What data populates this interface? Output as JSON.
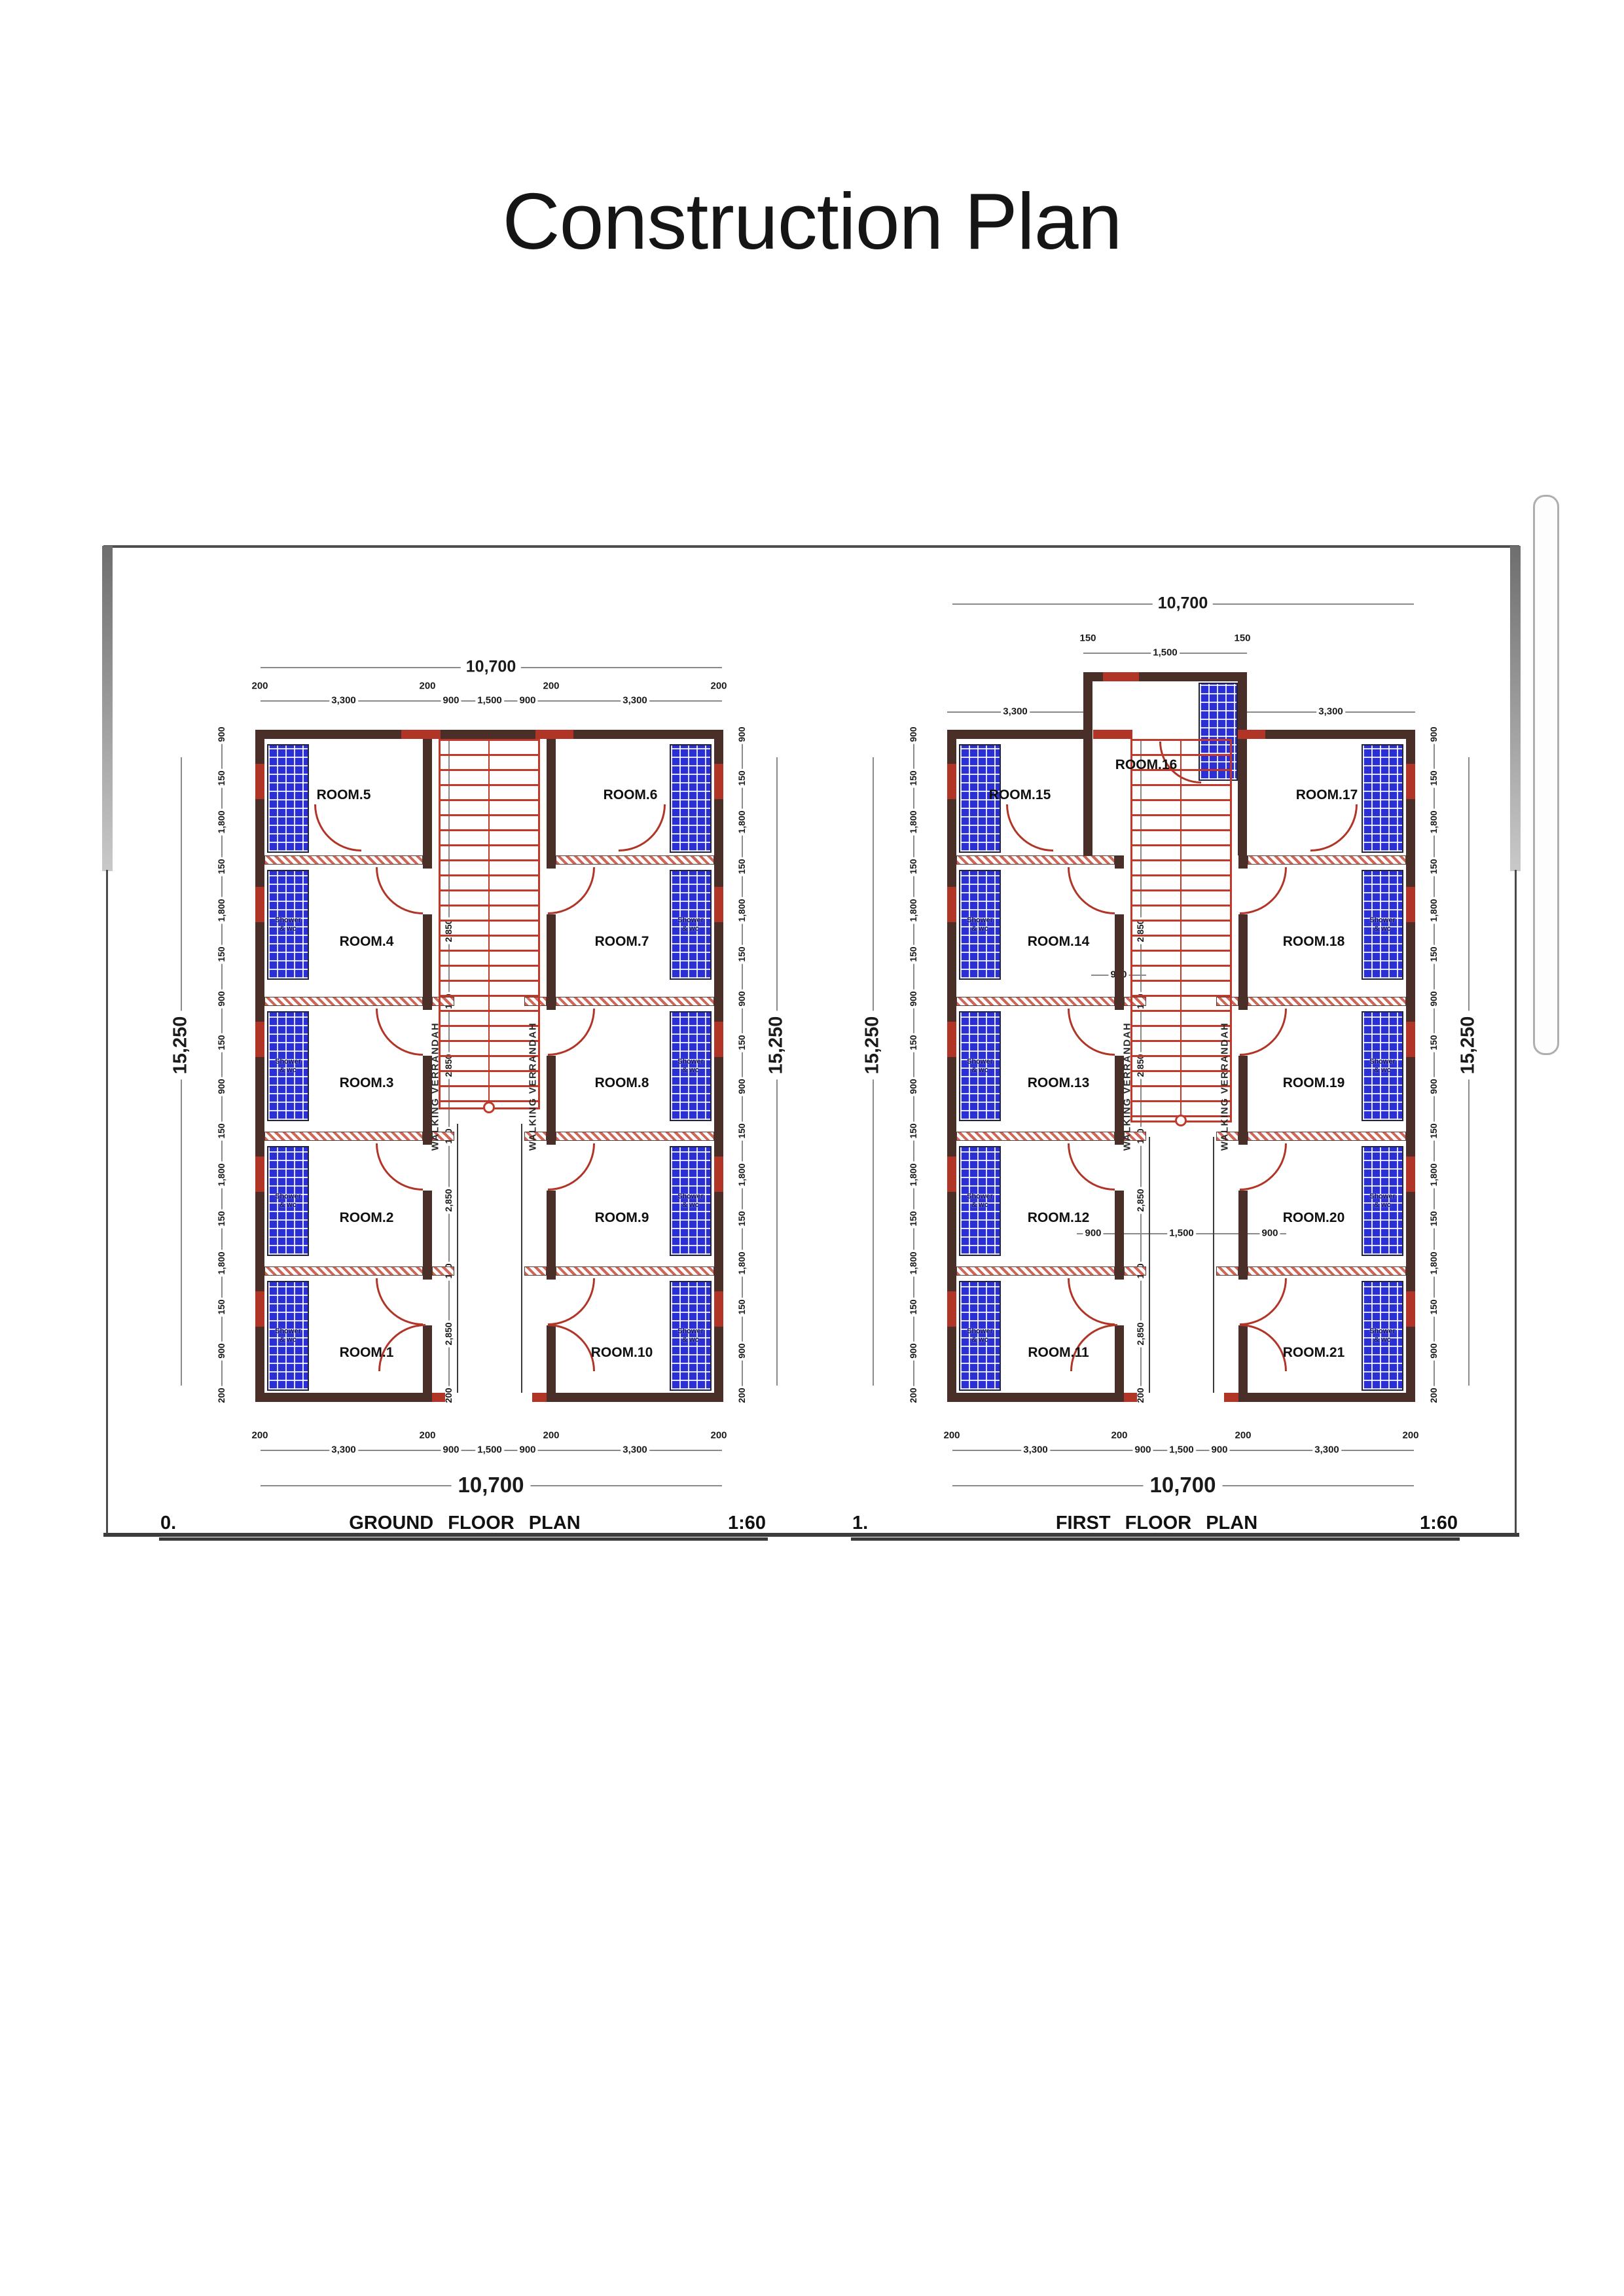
{
  "page": {
    "title": "Construction Plan"
  },
  "colors": {
    "wall": "#4a2f28",
    "hatch": "#cf6657",
    "door": "#b13527",
    "tile": "#2a2fd6",
    "tile_text": "#101060",
    "stair": "#c0392b",
    "dim_line": "#8a8a8a",
    "dim_text": "#1a1a1a",
    "underline": "#3a3a3a"
  },
  "shower_label_line1": "Shower",
  "shower_label_line2": "& wc",
  "corridor_label": "WALKING VERRANDAH",
  "plans": [
    {
      "id": "ground-floor",
      "index_label": "0.",
      "title": "GROUND FLOOR PLAN",
      "scale_label": "1:60",
      "top_overall": "10,700",
      "bottom_overall": "10,700",
      "side_overall": "15,250",
      "top_chain": [
        "200",
        "3,300",
        "200",
        "900",
        "1,500",
        "900",
        "200",
        "3,300",
        "200"
      ],
      "bottom_chain": [
        "200",
        "3,300",
        "200",
        "900",
        "1,500",
        "900",
        "200",
        "3,300",
        "200"
      ],
      "side_chain": [
        "900",
        "150",
        "1,800",
        "150",
        "1,800",
        "150",
        "900",
        "150",
        "900",
        "150",
        "1,800",
        "150",
        "1,800",
        "150",
        "900",
        "200"
      ],
      "interior_chain": [
        "2,850",
        "150",
        "2,850",
        "150",
        "2,850",
        "150",
        "2,850",
        "200"
      ],
      "top_rooms": [
        "ROOM.5",
        "ROOM.6"
      ],
      "left_rooms": [
        "ROOM.4",
        "ROOM.3",
        "ROOM.2",
        "ROOM.1"
      ],
      "right_rooms": [
        "ROOM.7",
        "ROOM.8",
        "ROOM.9",
        "ROOM.10"
      ]
    },
    {
      "id": "first-floor",
      "index_label": "1.",
      "title": "FIRST FLOOR PLAN",
      "scale_label": "1:60",
      "top_overall": "10,700",
      "bottom_overall": "10,700",
      "side_overall": "15,250",
      "top_chain": [
        "200",
        "3,300",
        "200",
        "900",
        "1,500",
        "900",
        "200",
        "3,300",
        "200"
      ],
      "bottom_chain": [
        "200",
        "3,300",
        "200",
        "900",
        "1,500",
        "900",
        "200",
        "3,300",
        "200"
      ],
      "side_chain": [
        "900",
        "150",
        "1,800",
        "150",
        "1,800",
        "150",
        "900",
        "150",
        "900",
        "150",
        "1,800",
        "150",
        "1,800",
        "150",
        "900",
        "200"
      ],
      "interior_chain": [
        "2,850",
        "150",
        "2,850",
        "150",
        "2,850",
        "150",
        "2,850",
        "200"
      ],
      "bay_room": "ROOM.16",
      "bay_chain": [
        "150",
        "1,500",
        "150"
      ],
      "upper_side_dims": [
        "3,300",
        "3,300"
      ],
      "mid_chain": [
        "900",
        "1,500",
        "900"
      ],
      "stair_dim": "900",
      "top_rooms": [
        "ROOM.15",
        "ROOM.17"
      ],
      "left_rooms": [
        "ROOM.14",
        "ROOM.13",
        "ROOM.12",
        "ROOM.11"
      ],
      "right_rooms": [
        "ROOM.18",
        "ROOM.19",
        "ROOM.20",
        "ROOM.21"
      ]
    }
  ]
}
